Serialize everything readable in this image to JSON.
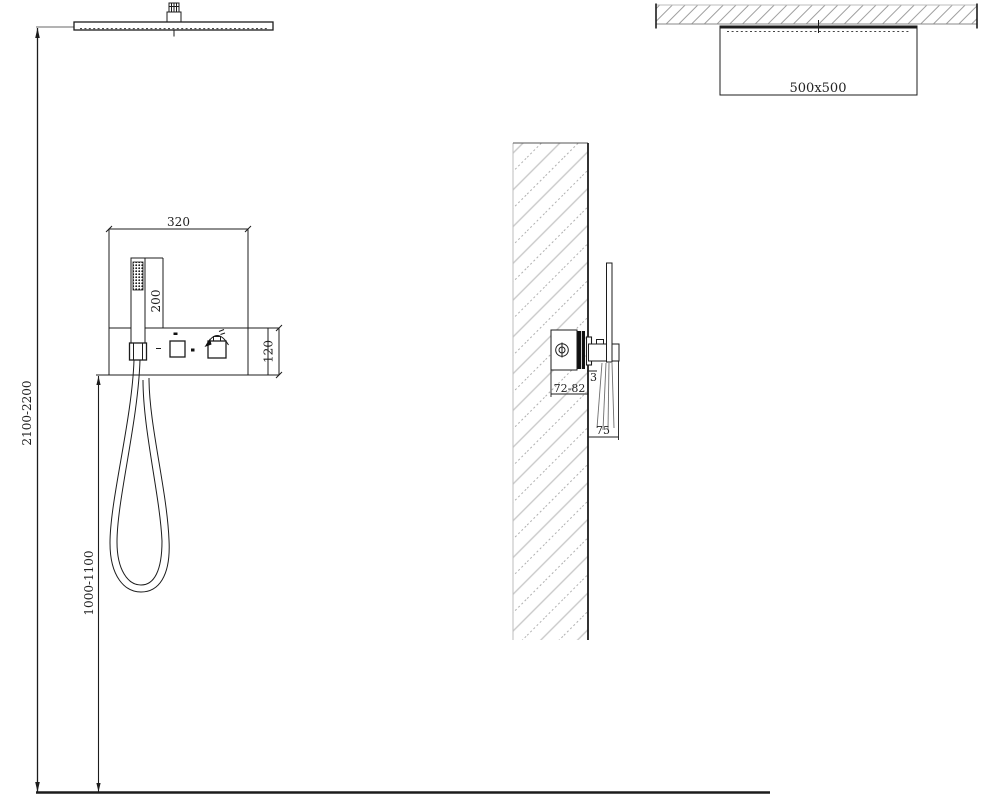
{
  "meta": {
    "description": "Technical installation drawing of a concealed ceiling rain shower system with hand shower panel",
    "views": [
      "front-elevation",
      "wall-section-side",
      "ceiling-section"
    ]
  },
  "colors": {
    "line": "#1c1c1c",
    "hatch_light": "#c6c6c6",
    "hatch_dark": "#a8a8a8",
    "leader_gray": "#9a9a9a",
    "text": "#222222",
    "background": "#ffffff"
  },
  "front_view": {
    "dim_panel_width": "320",
    "dim_hand_shower_length": "200",
    "dim_panel_height": "120",
    "dim_ceiling_height": "2100-2200",
    "dim_hose_mount_height": "1000-1100"
  },
  "side_view": {
    "dim_recess_depth": "72-82",
    "dim_plate_thickness": "3",
    "dim_holder_projection": "75"
  },
  "ceiling_view": {
    "dim_head_size": "500x500"
  }
}
